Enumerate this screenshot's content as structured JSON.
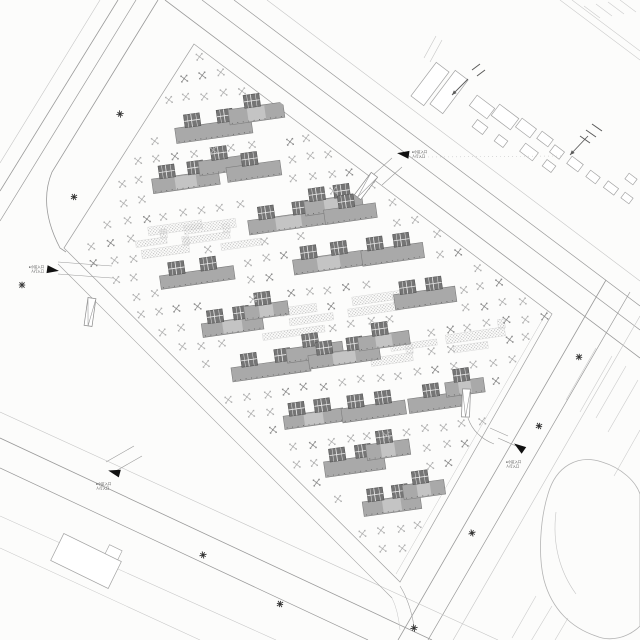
{
  "palette": {
    "paper": "#fcfcfb",
    "road_line": "#9a9a9a",
    "road_line_faint": "#c6c6c6",
    "site_path": "#a0a0a0",
    "building_fill": "#a9a9a9",
    "building_fill_light": "#c4c4c4",
    "building_outline": "#7d7d7d",
    "core_fill": "#757575",
    "core_outline": "#4f4f4f",
    "core_grid": "#ebebeb",
    "tree_light": "#b2b2b2",
    "tree_dark": "#8d8d8d",
    "shrub_dot": "#bdbdbd",
    "outside_outline": "#a3a3a3",
    "pond_outline": "#b4b4b4",
    "hatch": "#cccccc",
    "marker_dark": "#333333",
    "text": "#3f3f3f",
    "arrow": "#5a5a5a"
  },
  "entrances": [
    {
      "id": "west",
      "label_lines": [
        "●小区入口",
        "人行入口"
      ]
    },
    {
      "id": "northeast",
      "label_lines": [
        "●小区入口",
        "人行入口"
      ]
    },
    {
      "id": "southwest",
      "label_lines": [
        "●小区入口",
        "人行入口"
      ]
    },
    {
      "id": "east",
      "label_lines": [
        "●小区入口",
        "人行入口"
      ]
    }
  ],
  "icons": {
    "entrance-marker-icon": "▲",
    "street-lamp-icon": "✳",
    "direction-arrow-icon": "↙",
    "tree-icon": "⊠"
  }
}
